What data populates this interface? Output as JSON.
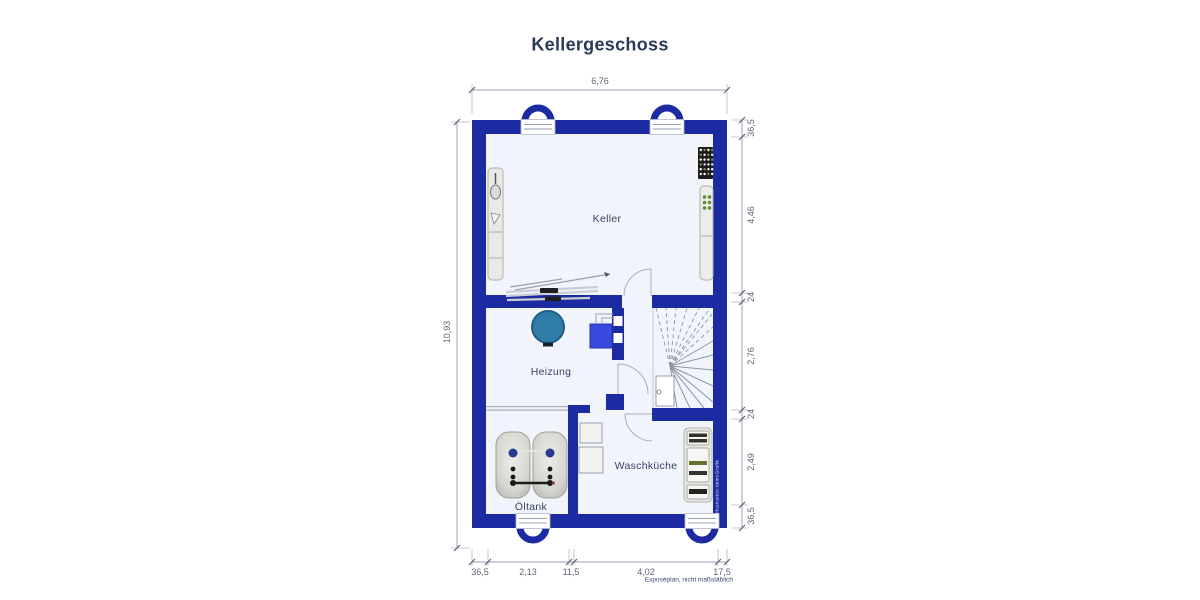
{
  "title": "Kellergeschoss",
  "footnote": "Exposéplan, nicht maßstäblich",
  "watermark": "Illustration ImmoGrafik",
  "rooms": {
    "keller": {
      "label": "Keller"
    },
    "heizung": {
      "label": "Heizung"
    },
    "waschkueche": {
      "label": "Waschküche"
    },
    "oeltank": {
      "label": "Öltank"
    }
  },
  "dimensions": {
    "top": {
      "total": "6,76"
    },
    "left": {
      "total": "10,93"
    },
    "right": [
      "36,5",
      "4,46",
      "24",
      "2,76",
      "24",
      "2,49",
      "36,5"
    ],
    "bottom": [
      "36,5",
      "2,13",
      "11,5",
      "4,02",
      "17,5"
    ]
  },
  "colors": {
    "wall_navy": "#1d2ba2",
    "room_fill": "#f1f5fb",
    "boiler_blue": "#3a48dd",
    "water_tank_teal": "#2f7da7",
    "label_text": "#36425f",
    "dimension_text": "#5d6575"
  }
}
